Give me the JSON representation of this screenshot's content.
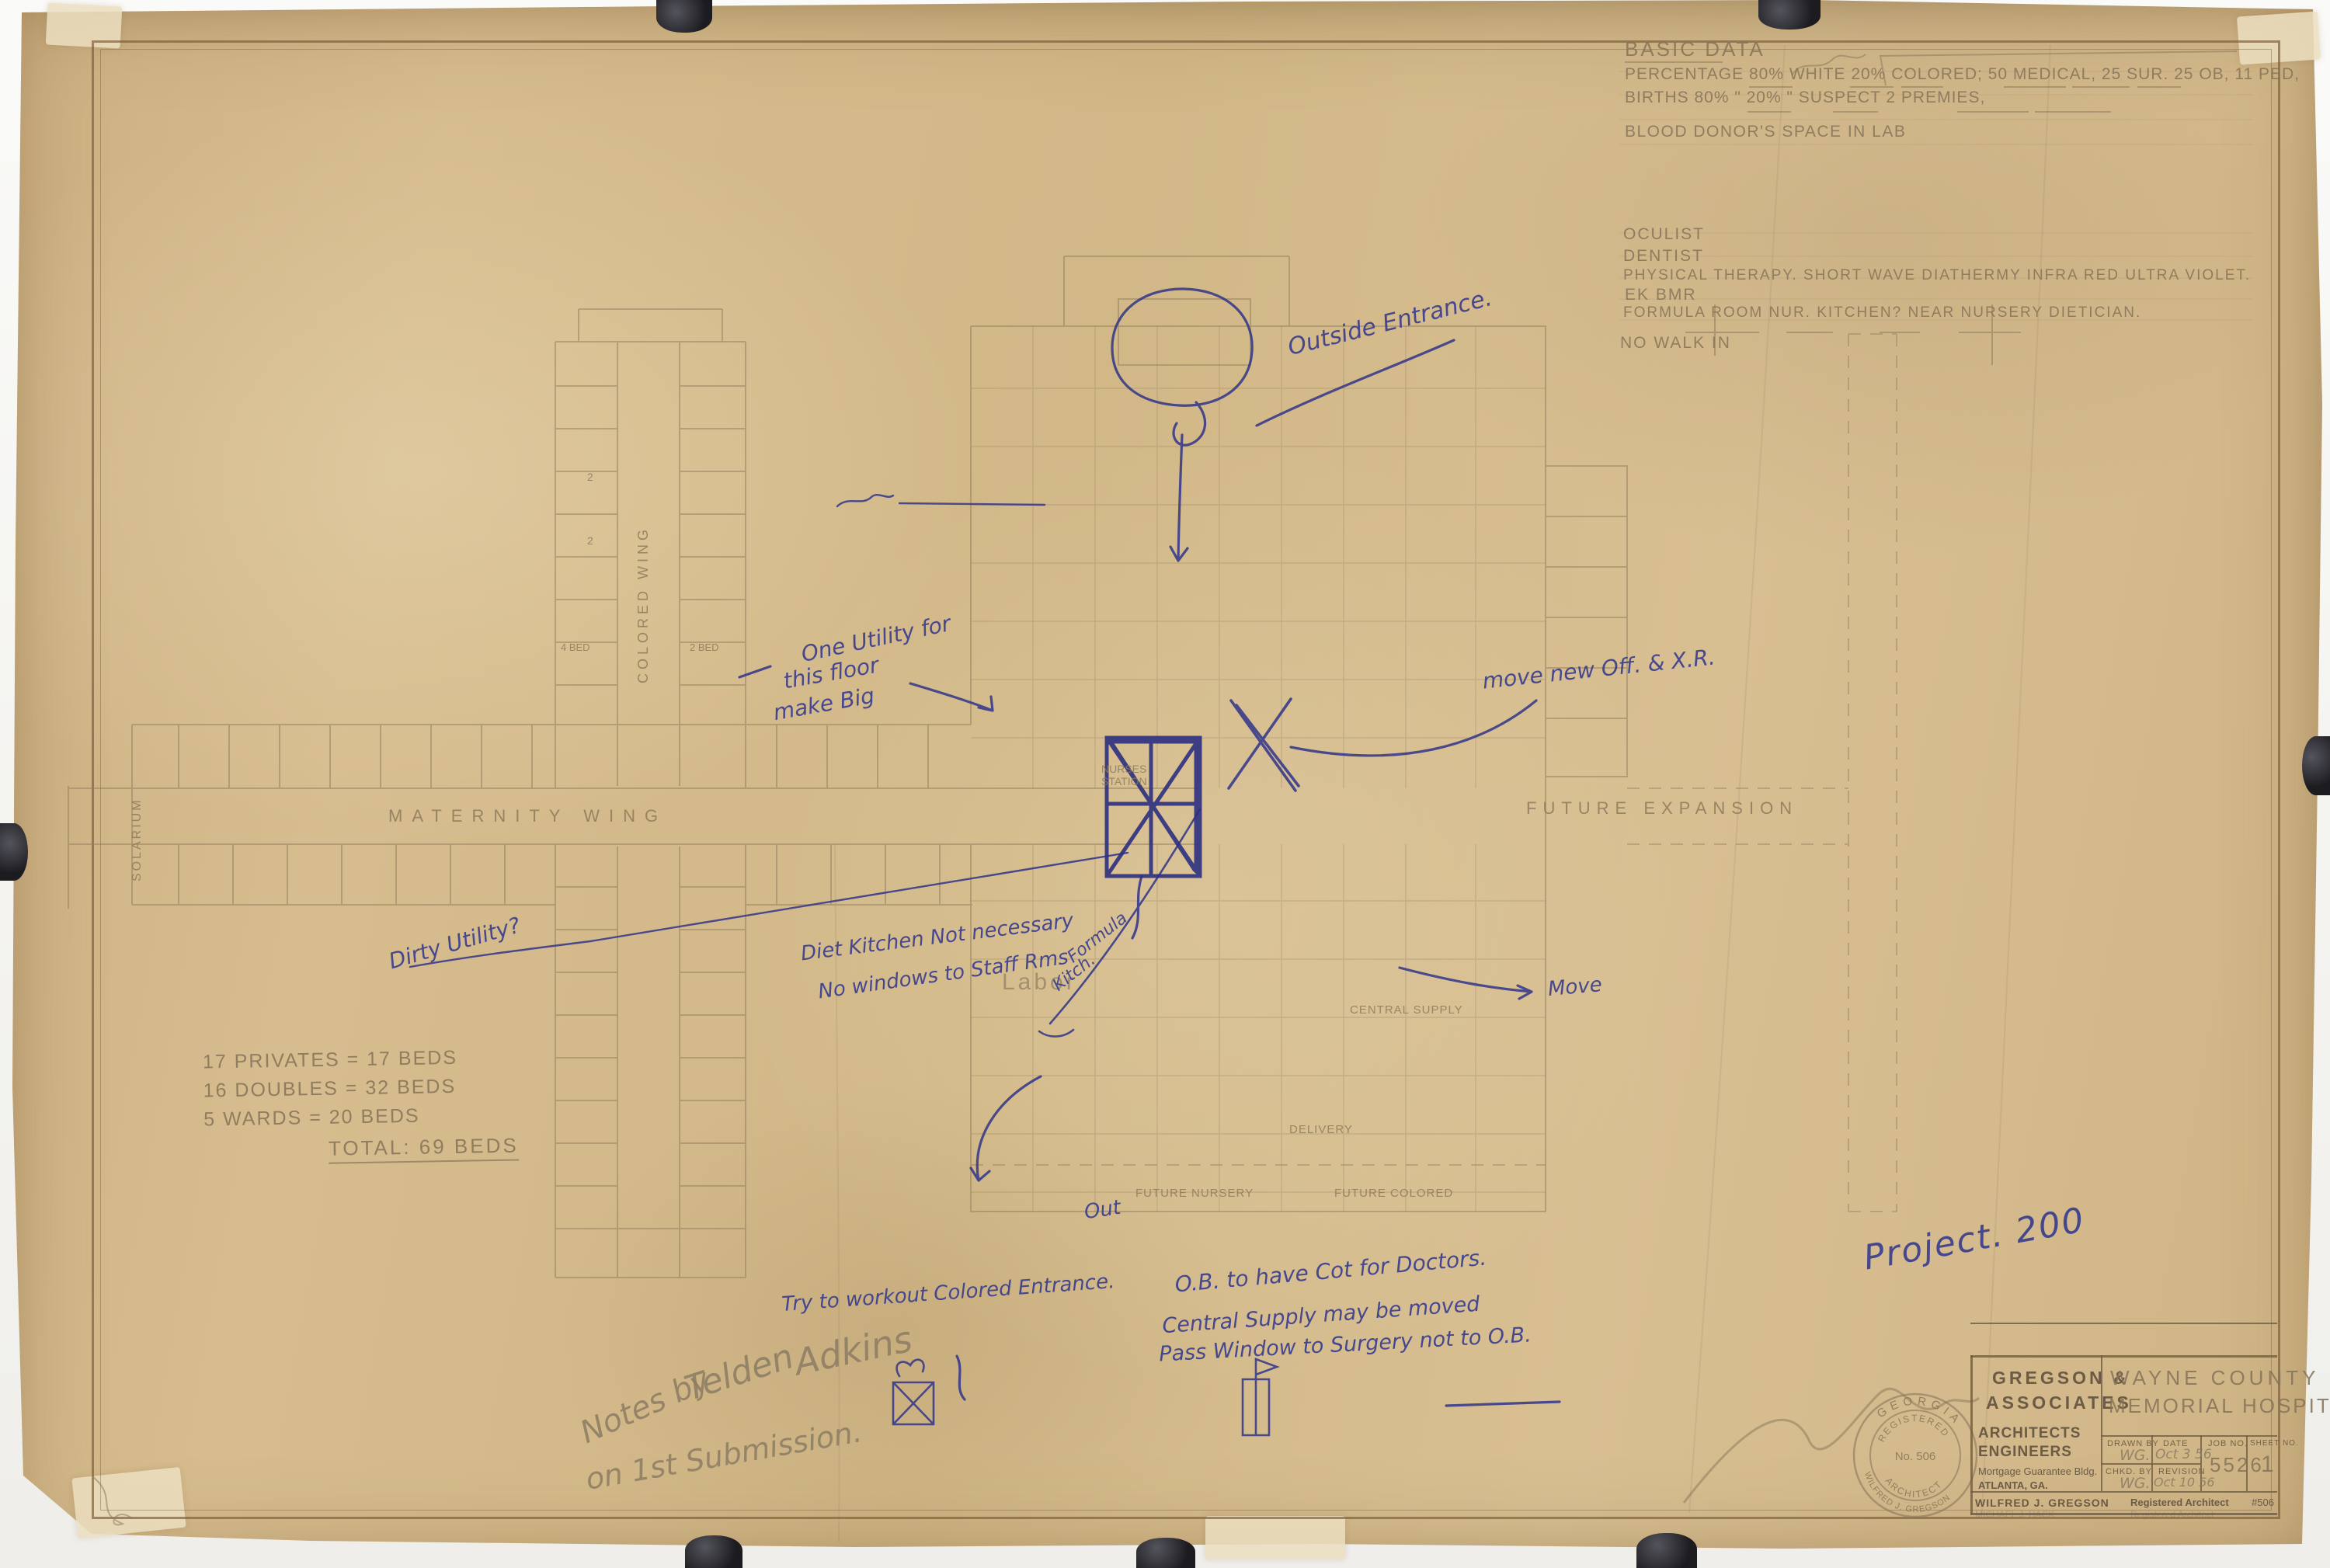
{
  "colors": {
    "paper": "#d4ba8e",
    "ink_blue": "#3a3e8e",
    "pencil": "#8d7b5c",
    "border_brown": "#8a6f4e"
  },
  "basic_data": {
    "title": "BASIC DATA",
    "line_percentage": "PERCENTAGE  80%  WHITE  20% COLORED;   50  MEDICAL,  25 SUR.  25 OB,  11 PED,",
    "line_births": "BIRTHS        80%    \"    20%    \"          SUSPECT    2 PREMIES,",
    "line_blood": "BLOOD DONOR'S    SPACE IN LAB",
    "line_oculist": "OCULIST",
    "line_dentist": "DENTIST",
    "line_pt": "PHYSICAL THERAPY.   SHORT WAVE DIATHERMY   INFRA RED   ULTRA VIOLET.",
    "line_ek": "EK  BMR",
    "line_formula": "FORMULA ROOM   NUR. KITCHEN?   NEAR NURSERY   DIETICIAN.",
    "line_nowalk": "NO WALK IN"
  },
  "bed_tally": {
    "row1": "17  PRIVATES    =    17 BEDS",
    "row2": "16  DOUBLES     =    32 BEDS",
    "row3": "5   WARDS       =    20 BEDS",
    "total": "TOTAL: 69 BEDS"
  },
  "ink_notes": {
    "outside_entrance": "Outside Entrance.",
    "move_new_off": "move new Off. & X.R.",
    "one_utility_1": "One Utility for",
    "one_utility_2": "this floor",
    "one_utility_3": "make Big",
    "dirty_utility": "Dirty Utility?",
    "diet_kitchen_1": "Diet Kitchen Not necessary",
    "diet_kitchen_2": "No windows to Staff Rms",
    "formula_1": "Formula",
    "formula_2": "Kitch.",
    "move": "Move",
    "out": "Out",
    "ob_1": "O.B. to have Cot for Doctors.",
    "ob_2": "Central Supply may be moved",
    "ob_3": "Pass Window to Surgery not to O.B.",
    "colored_entrance": "Try to workout Colored Entrance.",
    "project": "Project.  200"
  },
  "pencil_notes": {
    "tilden_1": "Notes by",
    "tilden_2": "Telden",
    "tilden_3": "Adkins",
    "tilden_4": "on 1st Submission."
  },
  "plan_labels": {
    "solarium": "SOLARIUM",
    "maternity_wing": "MATERNITY WING",
    "colored_wing": "COLORED WING",
    "nurses_station_1": "NURSES",
    "nurses_station_2": "STATION",
    "labor": "Labor",
    "central_supply": "CENTRAL SUPPLY",
    "delivery": "DELIVERY",
    "future_nursery": "FUTURE NURSERY",
    "future_colored": "FUTURE COLORED",
    "future_expansion": "FUTURE EXPANSION",
    "bed_4": "4 BED",
    "bed_2": "2 BED",
    "room_2": "2"
  },
  "title_block": {
    "firm_line1": "GREGSON &",
    "firm_line2": "ASSOCIATES",
    "role_line1": "ARCHITECTS",
    "role_line2": "ENGINEERS",
    "address_line1": "Mortgage Guarantee Bldg.",
    "address_line2": "ATLANTA, GA.",
    "project_line1": "WAYNE  COUNTY",
    "project_line2": "MEMORIAL  HOSPITAL",
    "drawn_by_label": "DRAWN BY",
    "drawn_by_value": "WG.",
    "date_label": "DATE",
    "date_value": "Oct 3 56",
    "chkd_label": "CHKD. BY",
    "chkd_value": "WG.",
    "revision_label": "REVISION",
    "revision_value": "Oct 10 56",
    "job_label": "JOB NO.",
    "job_value": "5526",
    "sheet_label": "SHEET NO.",
    "sheet_value": "1",
    "architect_name": "WILFRED J. GREGSON",
    "registered_text": "Registered Architect",
    "license_no": "#506",
    "faded_name": "MICHAEL J. HACK",
    "faded_registered": "Registered Architect"
  },
  "stamp": {
    "arc_top": "GEORGIA",
    "line1": "REGISTERED",
    "line2": "No. 506",
    "line3": "ARCHITECT",
    "arc_bottom": "WILFRED J. GREGSON"
  }
}
